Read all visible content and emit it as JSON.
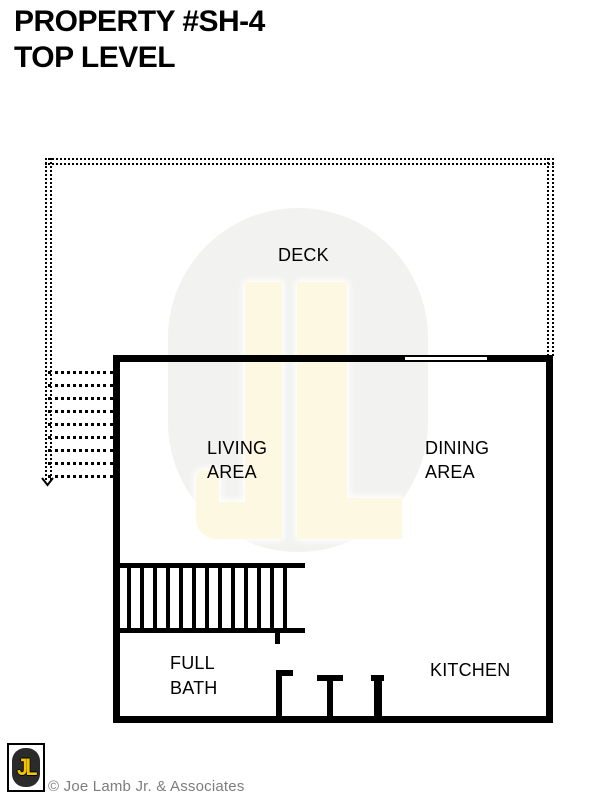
{
  "title": {
    "line1": "PROPERTY #SH-4",
    "line2": "TOP LEVEL"
  },
  "rooms": {
    "deck": "DECK",
    "living": {
      "line1": "LIVING",
      "line2": "AREA"
    },
    "dining": {
      "line1": "DINING",
      "line2": "AREA"
    },
    "bath": {
      "line1": "FULL",
      "line2": "BATH"
    },
    "kitchen": "KITCHEN"
  },
  "watermark": {
    "text": "JL"
  },
  "footer": {
    "logo_text": "JL",
    "copyright": "© Joe Lamb Jr. & Associates"
  },
  "colors": {
    "line": "#000000",
    "watermark_oval": "#f2f2f0",
    "watermark_letters": "#fcf8e2",
    "logo_yellow": "#f2c500",
    "logo_dark": "#2b2b2b",
    "copyright_gray": "#7d7d7d"
  },
  "plan": {
    "exterior_stair_steps": 9,
    "interior_stair_treads": 13
  }
}
